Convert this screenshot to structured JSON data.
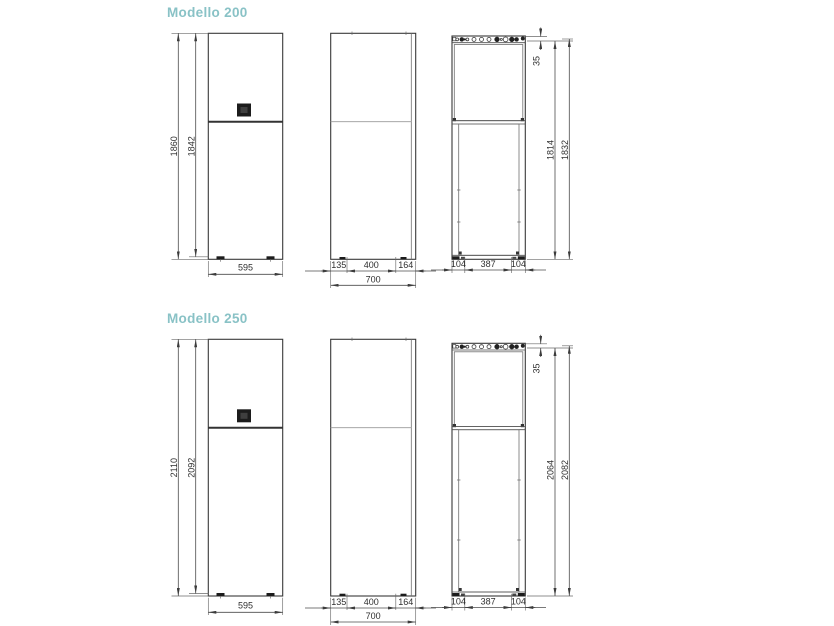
{
  "accent_color": "#89c2c6",
  "line_color": "#383838",
  "sections": [
    {
      "title": "Modello 200",
      "front": {
        "height_total": "1860",
        "height_body": "1842",
        "width": "595"
      },
      "side": {
        "segments": [
          "135",
          "400",
          "164"
        ],
        "total_depth": "700"
      },
      "rear": {
        "top_offset": "35",
        "height_frame": "1814",
        "height_total": "1832",
        "segments": [
          "104",
          "387",
          "104"
        ]
      }
    },
    {
      "title": "Modello 250",
      "front": {
        "height_total": "2110",
        "height_body": "2092",
        "width": "595"
      },
      "side": {
        "segments": [
          "135",
          "400",
          "164"
        ],
        "total_depth": "700"
      },
      "rear": {
        "top_offset": "35",
        "height_frame": "2064",
        "height_total": "2082",
        "segments": [
          "104",
          "387",
          "104"
        ]
      }
    }
  ]
}
